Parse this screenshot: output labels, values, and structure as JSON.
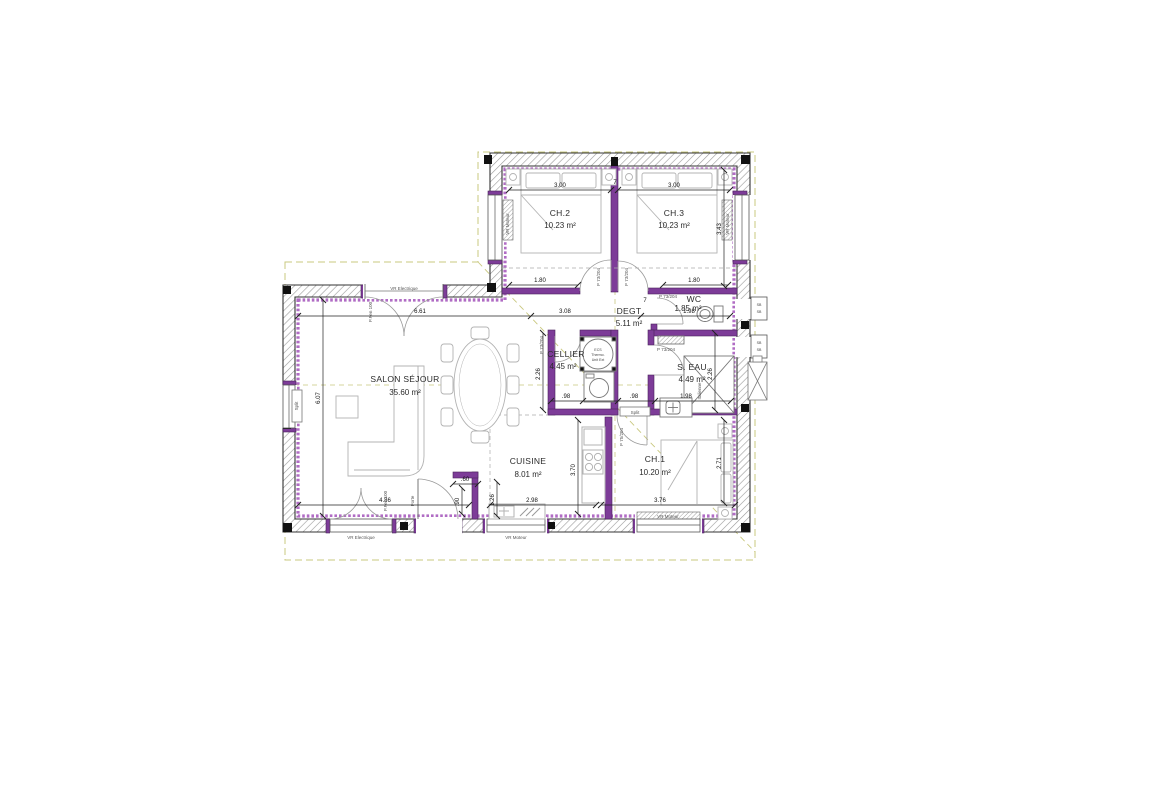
{
  "plan": {
    "rooms": [
      {
        "name": "CH.2",
        "area": "10.23 m²"
      },
      {
        "name": "CH.3",
        "area": "10.23 m²"
      },
      {
        "name": "DEGT",
        "area": "5.11 m²"
      },
      {
        "name": "WC",
        "area": "1.85 m²"
      },
      {
        "name": "CELLIER",
        "area": "4.45 m²"
      },
      {
        "name": "S. EAU",
        "area": "4.49 m²"
      },
      {
        "name": "SALON SÉJOUR",
        "area": "35.60 m²"
      },
      {
        "name": "CUISINE",
        "area": "8.01 m²"
      },
      {
        "name": "CH.1",
        "area": "10.20 m²"
      }
    ],
    "dims": [
      "3.00",
      "3.43",
      "1.80",
      "6.61",
      "3.08",
      "1.98",
      "6.07",
      "2.26",
      ".98",
      "3.70",
      "2.98",
      "4.86",
      "3.76",
      "2.71",
      "1.26",
      ".60",
      ".90",
      "7"
    ],
    "openings": {
      "door_int": "P 73/204",
      "door_int_large": "P 75/204",
      "window_motor": "VR Moteur",
      "window_electric": "VR Electrique",
      "french_door": "P.Fen 100",
      "entry": "Porte"
    },
    "equipment": {
      "ecs": [
        "ECS",
        "Thermo.",
        "Unit Ext"
      ],
      "split": "Split",
      "shower": "Italienne",
      "vent": "SB"
    },
    "colors": {
      "partition": "#7d3c98",
      "insulation": "#b06cc4",
      "wall_hatch": "#9a9a9a",
      "boundary": "#c9c87f",
      "dimension": "#222222"
    }
  }
}
